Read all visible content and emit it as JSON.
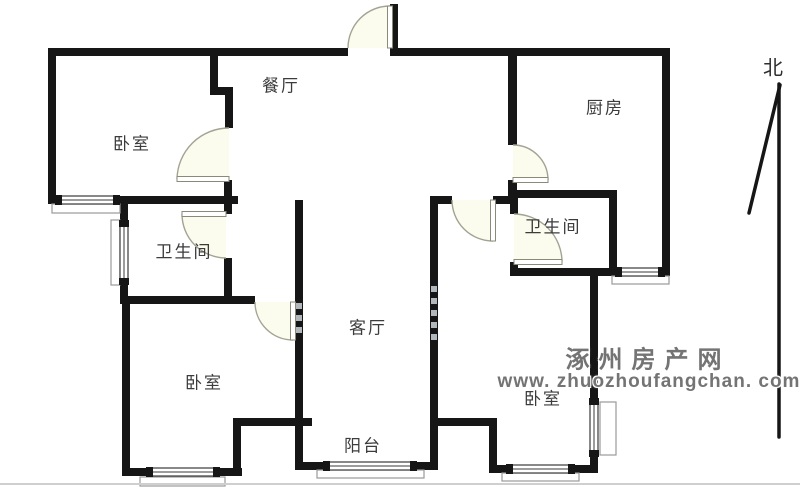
{
  "meta": {
    "width": 800,
    "height": 487
  },
  "colors": {
    "wall": "#161616",
    "door_arc": "#a3a393",
    "door_fill": "#fbfbee",
    "window_line": "#3a3a3a",
    "sill": "#9a9a9a",
    "label": "#3c3c3c",
    "watermark": "#747474",
    "photo_edge": "#cfcfcf"
  },
  "compass": {
    "label": "北",
    "x": 773,
    "y": 66
  },
  "watermark": {
    "line1": "涿州房产网",
    "line2": "www. zhuozhoufangchan. com",
    "pos1": {
      "x": 648,
      "y": 357
    },
    "pos2": {
      "x": 649,
      "y": 382
    }
  },
  "rooms": {
    "bedroom_nw": {
      "label": "卧室",
      "x": 132,
      "y": 142
    },
    "dining": {
      "label": "餐厅",
      "x": 281,
      "y": 84
    },
    "kitchen": {
      "label": "厨房",
      "x": 605,
      "y": 106
    },
    "bath_w": {
      "label": "卫生间",
      "x": 184,
      "y": 250
    },
    "bath_e": {
      "label": "卫生间",
      "x": 553,
      "y": 225
    },
    "living": {
      "label": "客厅",
      "x": 368,
      "y": 326
    },
    "bedroom_sw": {
      "label": "卧室",
      "x": 204,
      "y": 381
    },
    "bedroom_se": {
      "label": "卧室",
      "x": 543,
      "y": 397
    },
    "balcony": {
      "label": "阳台",
      "x": 363,
      "y": 444
    }
  },
  "floorplan": {
    "walls": [
      [
        48,
        48,
        300,
        8
      ],
      [
        390,
        48,
        280,
        8
      ],
      [
        390,
        4,
        8,
        46
      ],
      [
        48,
        48,
        8,
        156
      ],
      [
        210,
        48,
        8,
        47
      ],
      [
        210,
        87,
        23,
        8
      ],
      [
        225,
        95,
        8,
        33
      ],
      [
        224,
        180,
        8,
        34
      ],
      [
        224,
        258,
        8,
        46
      ],
      [
        48,
        196,
        190,
        8
      ],
      [
        120,
        204,
        8,
        18
      ],
      [
        120,
        283,
        8,
        21
      ],
      [
        120,
        296,
        135,
        8
      ],
      [
        295,
        200,
        8,
        270
      ],
      [
        122,
        296,
        8,
        180
      ],
      [
        122,
        468,
        120,
        8
      ],
      [
        233,
        418,
        8,
        58
      ],
      [
        233,
        418,
        79,
        8
      ],
      [
        295,
        462,
        143,
        8
      ],
      [
        430,
        196,
        8,
        274
      ],
      [
        430,
        418,
        67,
        8
      ],
      [
        489,
        418,
        8,
        55
      ],
      [
        489,
        465,
        109,
        8
      ],
      [
        590,
        273,
        8,
        127
      ],
      [
        590,
        455,
        8,
        18
      ],
      [
        430,
        196,
        22,
        8
      ],
      [
        493,
        196,
        17,
        8
      ],
      [
        508,
        48,
        9,
        97
      ],
      [
        508,
        180,
        9,
        20
      ],
      [
        510,
        190,
        107,
        8
      ],
      [
        510,
        190,
        8,
        24
      ],
      [
        510,
        262,
        8,
        14
      ],
      [
        609,
        190,
        8,
        86
      ],
      [
        510,
        268,
        160,
        8
      ],
      [
        662,
        48,
        8,
        228
      ]
    ],
    "hatches": [
      [
        296,
        303,
        6,
        6
      ],
      [
        296,
        315,
        6,
        6
      ],
      [
        296,
        327,
        6,
        6
      ],
      [
        431,
        286,
        6,
        6
      ],
      [
        431,
        298,
        6,
        6
      ],
      [
        431,
        310,
        6,
        6
      ],
      [
        431,
        322,
        6,
        6
      ],
      [
        431,
        334,
        6,
        6
      ]
    ],
    "windows": [
      {
        "x": 57,
        "y": 196,
        "w": 61,
        "h": 8
      },
      {
        "x": 120,
        "y": 222,
        "w": 8,
        "h": 61
      },
      {
        "x": 617,
        "y": 268,
        "w": 46,
        "h": 8
      },
      {
        "x": 590,
        "y": 400,
        "w": 8,
        "h": 55
      },
      {
        "x": 508,
        "y": 465,
        "w": 65,
        "h": 8
      },
      {
        "x": 325,
        "y": 462,
        "w": 90,
        "h": 8
      },
      {
        "x": 148,
        "y": 468,
        "w": 70,
        "h": 8
      }
    ],
    "sills": [
      [
        52,
        204,
        68,
        9
      ],
      [
        111,
        220,
        9,
        65
      ],
      [
        612,
        276,
        57,
        8
      ],
      [
        600,
        402,
        16,
        53
      ],
      [
        502,
        473,
        77,
        8
      ],
      [
        317,
        470,
        107,
        8
      ],
      [
        140,
        477,
        85,
        9
      ]
    ],
    "doors": [
      {
        "name": "entrance-door",
        "hinge": [
          390,
          48
        ],
        "tip": [
          390,
          6
        ],
        "jamb": [
          348,
          48
        ]
      },
      {
        "name": "bedroom-nw-door",
        "hinge": [
          229,
          179
        ],
        "tip": [
          177,
          179
        ],
        "jamb": [
          229,
          128
        ]
      },
      {
        "name": "bathroom-w-door",
        "hinge": [
          226,
          214
        ],
        "tip": [
          182,
          214
        ],
        "jamb": [
          226,
          258
        ]
      },
      {
        "name": "bedroom-sw-door",
        "hinge": [
          293,
          302
        ],
        "tip": [
          293,
          340
        ],
        "jamb": [
          255,
          302
        ]
      },
      {
        "name": "bedroom-se-door",
        "hinge": [
          493,
          200
        ],
        "tip": [
          493,
          241
        ],
        "jamb": [
          452,
          200
        ]
      },
      {
        "name": "kitchen-door",
        "hinge": [
          513,
          180
        ],
        "tip": [
          548,
          180
        ],
        "jamb": [
          513,
          145
        ]
      },
      {
        "name": "bathroom-e-door",
        "hinge": [
          514,
          262
        ],
        "tip": [
          562,
          262
        ],
        "jamb": [
          514,
          214
        ]
      }
    ],
    "north_lines": [
      [
        779,
        84,
        779,
        437
      ],
      [
        749,
        213,
        780,
        85
      ]
    ],
    "bottom_edge": [
      0,
      483,
      800,
      2
    ]
  }
}
